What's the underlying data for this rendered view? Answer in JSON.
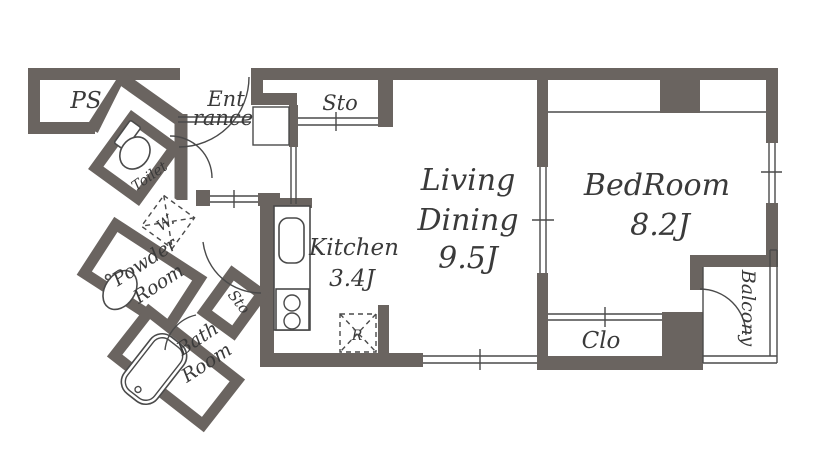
{
  "floorplan": {
    "type": "apartment-floor-plan",
    "colors": {
      "wall": "#6a6460",
      "line": "#4a4a4a",
      "text": "#3a3a3a",
      "bg": "#ffffff"
    },
    "rooms": {
      "ps": {
        "label": "PS"
      },
      "entrance": {
        "line1": "Ent",
        "line2": "rance"
      },
      "sto_top": {
        "label": "Sto"
      },
      "living": {
        "line1": "Living",
        "line2": "Dining",
        "line3": "9.5J"
      },
      "bedroom": {
        "line1": "BedRoom",
        "line2": "8.2J"
      },
      "toilet": {
        "label": "Toilet"
      },
      "washer": {
        "label": "W."
      },
      "powder": {
        "line1": "Powder",
        "line2": "Room"
      },
      "bath": {
        "line1": "Bath",
        "line2": "Room"
      },
      "sto_side": {
        "label": "Sto"
      },
      "kitchen": {
        "line1": "Kitchen",
        "line2": "3.4J"
      },
      "fridge": {
        "label": "R"
      },
      "closet": {
        "label": "Clo"
      },
      "balcony": {
        "label": "Balcony"
      }
    }
  }
}
